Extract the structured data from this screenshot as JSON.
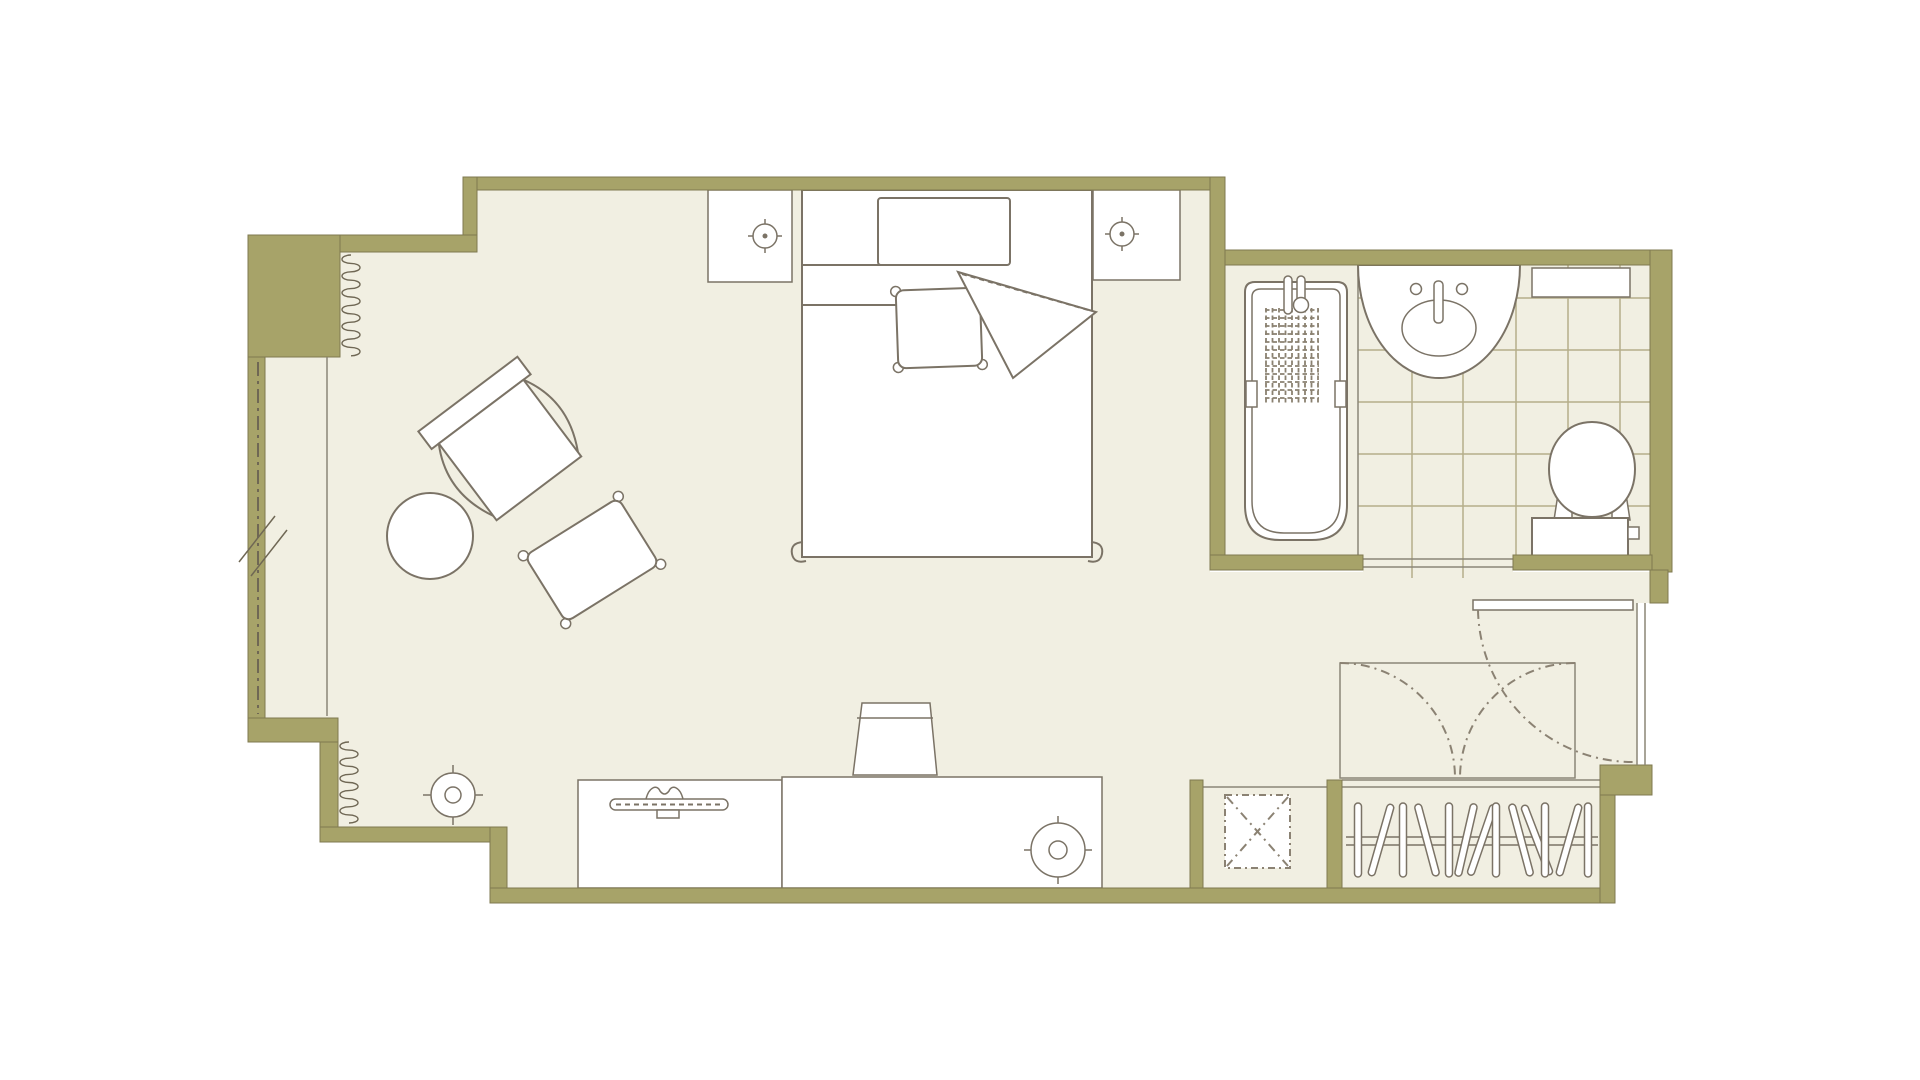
{
  "document": {
    "kind": "architectural-floor-plan",
    "visible_text": []
  },
  "colors": {
    "wall": "#a7a369",
    "wall_edge": "#7f7950",
    "floor": "#f1efe2",
    "furniture_line": "#7b7366",
    "detail_line": "#6f6754",
    "dash_line": "#8b8273",
    "tile_line": "#b5ae8a",
    "thin_line": "#8b8677",
    "mat_line": "#8a8170",
    "fixture_fill": "#ffffff",
    "background": "#ffffff"
  },
  "rooms": [
    {
      "name": "bedroom",
      "items": [
        "bed",
        "pillow",
        "pillow",
        "duvet-fold",
        "nightstand-left",
        "nightstand-right",
        "lamp",
        "lamp",
        "armchair",
        "side-table",
        "ottoman-pillow",
        "desk",
        "desk-chair",
        "floor-lamp",
        "tv-console",
        "tv",
        "table-lamp",
        "window-wall",
        "curtain-squiggle",
        "curtain-squiggle"
      ]
    },
    {
      "name": "bathroom",
      "items": [
        "bathtub",
        "tub-faucet",
        "bath-mat",
        "sink-counter",
        "sink",
        "toilet",
        "shelf",
        "tile-floor",
        "door-threshold"
      ]
    },
    {
      "name": "entry-vestibule",
      "items": [
        "entry-door",
        "door-swing-arc",
        "closet-doors",
        "door-swing-arc",
        "door-swing-arc"
      ]
    },
    {
      "name": "wardrobe-closet",
      "items": [
        "hanging-rod",
        "hangers"
      ]
    },
    {
      "name": "service-shaft",
      "items": [
        "shaft-x-marker"
      ]
    }
  ]
}
